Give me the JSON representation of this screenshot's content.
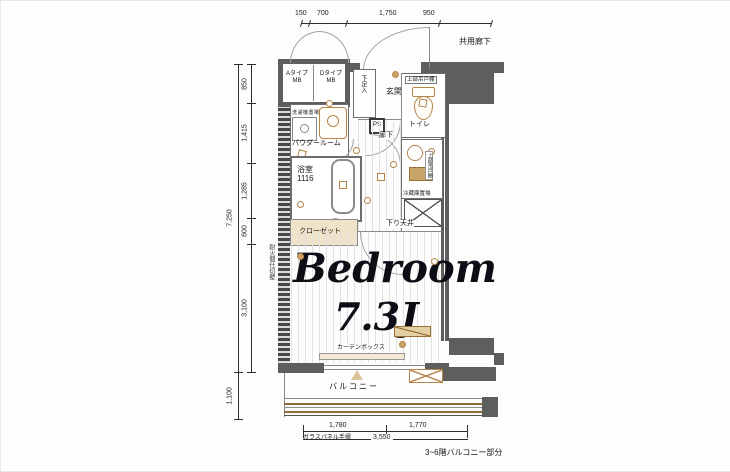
{
  "header": {
    "corridor_label": "共用廊下"
  },
  "meter_boxes": {
    "a_type": "Aタイプ",
    "a_sub": "MB",
    "d_type": "Dタイプ",
    "d_sub": "MB"
  },
  "rooms": {
    "shoe_cabinet": "下足入",
    "entrance": "玄関",
    "ps": "PS",
    "toilet": "トイレ",
    "toilet_shelf": "上部吊戸棚",
    "laundry": "洗濯機置場",
    "powder_room": "パウダールーム",
    "hallway": "廊下",
    "bathroom": "浴室",
    "bathroom_size": "1116",
    "kitchen_shelf": "上部吊戸棚",
    "fridge": "冷蔵庫置場",
    "closet": "クローゼット",
    "dropped_ceiling": "下り天井",
    "bedroom_name": "Bedroom",
    "bedroom_size": "7.3J",
    "curtain_box": "カーテンボックス",
    "balcony": "バルコニー",
    "glass_panel": "ガラスパネル手摺",
    "fire_wall": "耐火間仕切壁"
  },
  "dimensions": {
    "top": [
      "150",
      "700",
      "1,750",
      "950"
    ],
    "left_segments": [
      "850",
      "1,415",
      "1,285",
      "600",
      "3,100"
    ],
    "left_total": "7,250",
    "left_balcony": "1,100",
    "bottom_left": "1,780",
    "bottom_right": "1,770",
    "bottom_total": "3,550",
    "balcony_note": "3~6階バルコニー部分"
  },
  "colors": {
    "wall": "#5f5e5e",
    "fixture": "#b5854a",
    "line": "#2d2d2d"
  }
}
